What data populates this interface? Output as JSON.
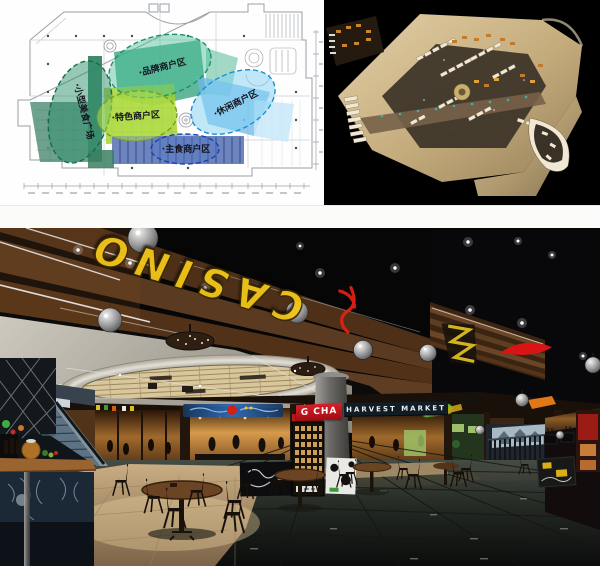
{
  "collage": {
    "panels": [
      "floor-plan-diagram",
      "aerial-3d-render",
      "interior-render"
    ]
  },
  "floor_plan": {
    "zones": [
      {
        "name": "brand-merchants",
        "label": "·品牌商户区",
        "fill": "#49bf96",
        "border": "#1f8f68"
      },
      {
        "name": "specialty-merchants",
        "label": "·特色商户区",
        "fill": "#b4e048",
        "border": "#7d9c1e"
      },
      {
        "name": "leisure-merchants",
        "label": "·休闲商户区",
        "fill": "#7fd0f2",
        "border": "#1f8fd0"
      },
      {
        "name": "staple-food-merchants",
        "label": "·主食商户区",
        "fill": "#5078c8",
        "border": "#1b3fae"
      },
      {
        "name": "small-food-plaza",
        "label": "·小型美食广场",
        "fill": "#2f8f6b",
        "border": "#176b4e"
      }
    ]
  },
  "interior": {
    "ceiling_sign": "CASINO",
    "ceiling_sign_color": "#f0c41a",
    "storefront_signs": [
      {
        "name": "gong-cha",
        "label": "G CHA",
        "bg": "#c01020"
      },
      {
        "name": "harvest-market",
        "label": "HARVEST MARKET",
        "bg": "#111c24"
      }
    ]
  }
}
